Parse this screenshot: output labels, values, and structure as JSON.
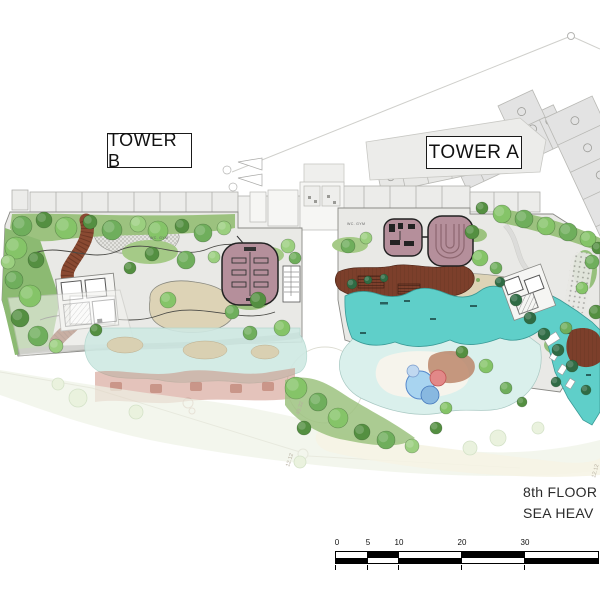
{
  "labels": {
    "tower_b": "TOWER B",
    "tower_a": "TOWER A"
  },
  "title": {
    "line1": "8th FLOOR",
    "line2": "SEA HEAV"
  },
  "rooms": {
    "gym_b": "WC. GYM",
    "gym_a": "WC. GYM"
  },
  "dims": {
    "d1": "49.32",
    "d2": "12.12",
    "d3": "12.12"
  },
  "scale": {
    "unit_labels": [
      "0",
      "5",
      "10",
      "20",
      "30"
    ]
  },
  "colors": {
    "pool": "#5FCFC9",
    "lagoon": "#D9F0EC",
    "deck_wood": "#7C3F2B",
    "fitness_area": "#B58F9B",
    "foliage": "#6FAE5C",
    "building": "#E3E3E3"
  }
}
